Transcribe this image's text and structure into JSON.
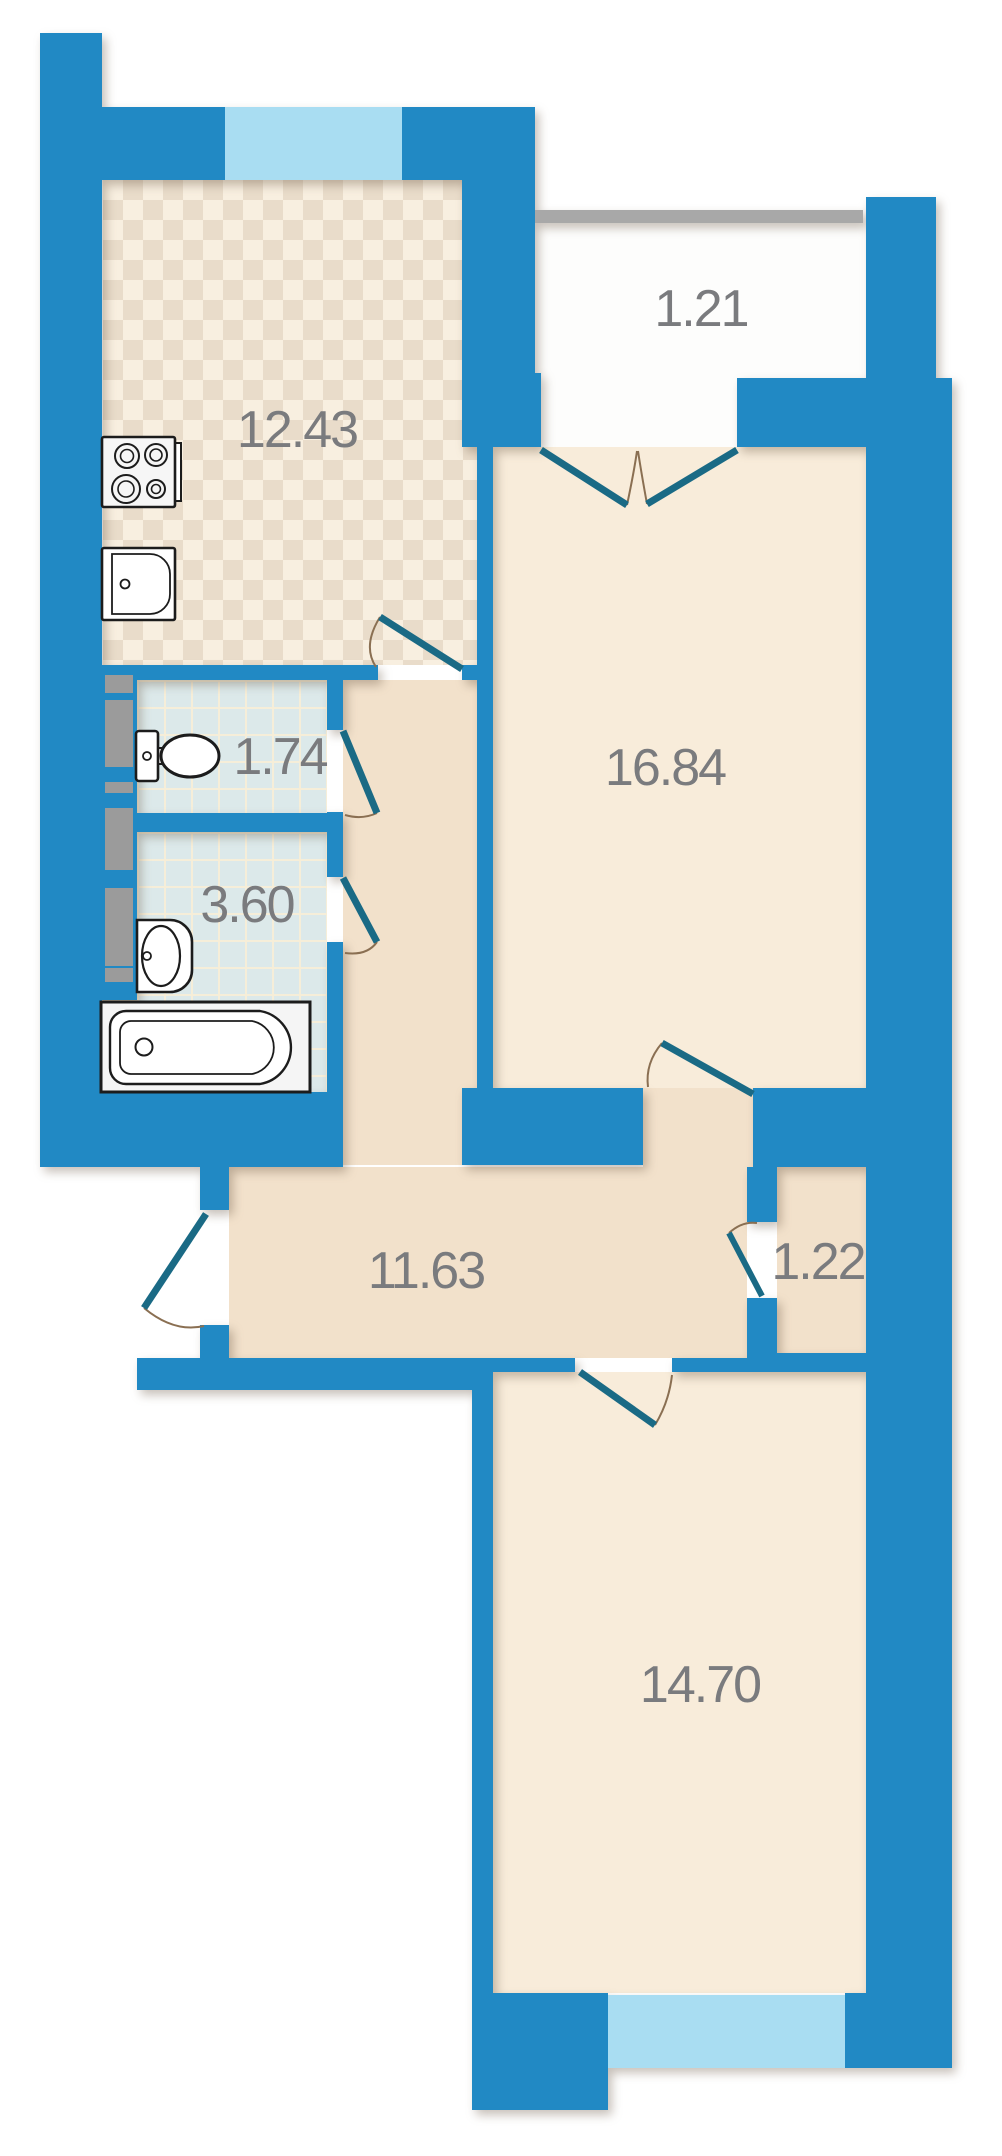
{
  "rooms": {
    "kitchen": {
      "label": "kitchen",
      "area": "12.43"
    },
    "balcony": {
      "label": "balcony",
      "area": "1.21"
    },
    "living_room": {
      "label": "living room",
      "area": "16.84"
    },
    "wc": {
      "label": "wc",
      "area": "1.74"
    },
    "bathroom": {
      "label": "bathroom",
      "area": "3.60"
    },
    "hallway": {
      "label": "hallway",
      "area": "11.63"
    },
    "storage": {
      "label": "storage",
      "area": "1.22"
    },
    "bedroom": {
      "label": "bedroom",
      "area": "14.70"
    }
  },
  "fixtures": [
    "stove",
    "kitchen-sink",
    "toilet",
    "washbasin",
    "bathtub"
  ],
  "colors": {
    "wall": "#2189c4",
    "window": "#a9ddf2",
    "railing": "#a8a8a8",
    "vent_shaft": "#9b9b9b",
    "room_floor": "#f8ecda",
    "hall_floor": "#f2e1cb",
    "kitchen_floor": "#f8efe0",
    "kitchen_check": "#e9dcca",
    "tile_floor": "#dce9ea",
    "balcony_floor": "#fdfdfc",
    "door_leaf": "#1a6a85",
    "door_arc": "#8a6f52",
    "label_text": "#7a7b7e"
  }
}
